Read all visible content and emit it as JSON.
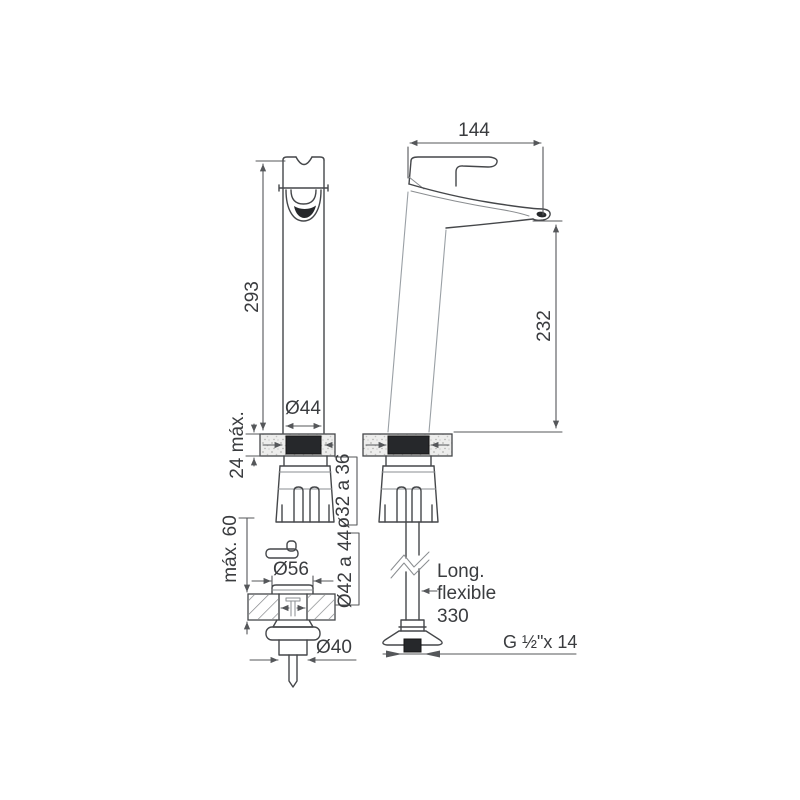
{
  "labels": {
    "spout_reach": "144",
    "total_height": "293",
    "spout_height": "232",
    "body_diameter": "Ø44",
    "deck_thickness_max": "24 máx.",
    "mounting_hole": "ø32 a 36",
    "drain_hole": "Ø42 a 44",
    "drain_flange": "Ø56",
    "counter_thickness_max": "máx. 60",
    "drain_outlet": "Ø40",
    "hose_line1": "Long.",
    "hose_line2": "flexible",
    "hose_line3": "330",
    "thread": "G ½\"x 14"
  },
  "colors": {
    "line": "#45474a",
    "dimension": "#55575a",
    "dark_fill": "#26282b",
    "background": "#ffffff"
  }
}
